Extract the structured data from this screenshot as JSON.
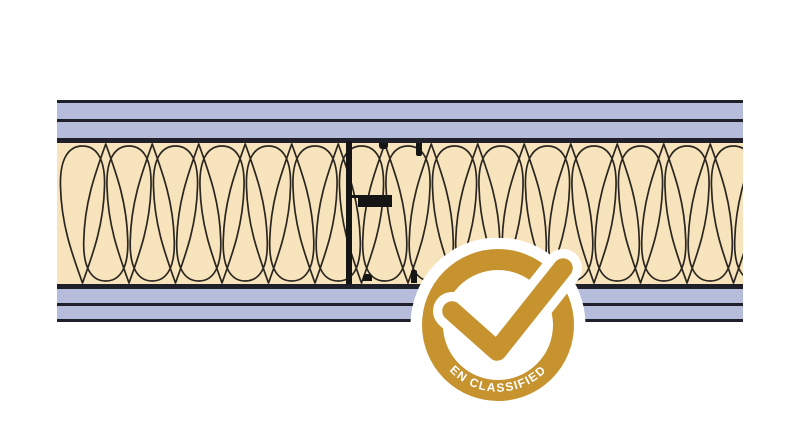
{
  "badge": {
    "label": "EN CLASSIFIED"
  },
  "colors": {
    "gold": "#C6932F",
    "white": "#FFFFFF",
    "board_blue": "#B5BCDC",
    "line_dark": "#20202A",
    "insulation_cream": "#F8E4BC",
    "hatch_line": "#2B2620",
    "stud_black": "#151515"
  },
  "diagram": {
    "top_board_sheets": 2,
    "bottom_board_sheets": 2,
    "stud_count": 1
  }
}
